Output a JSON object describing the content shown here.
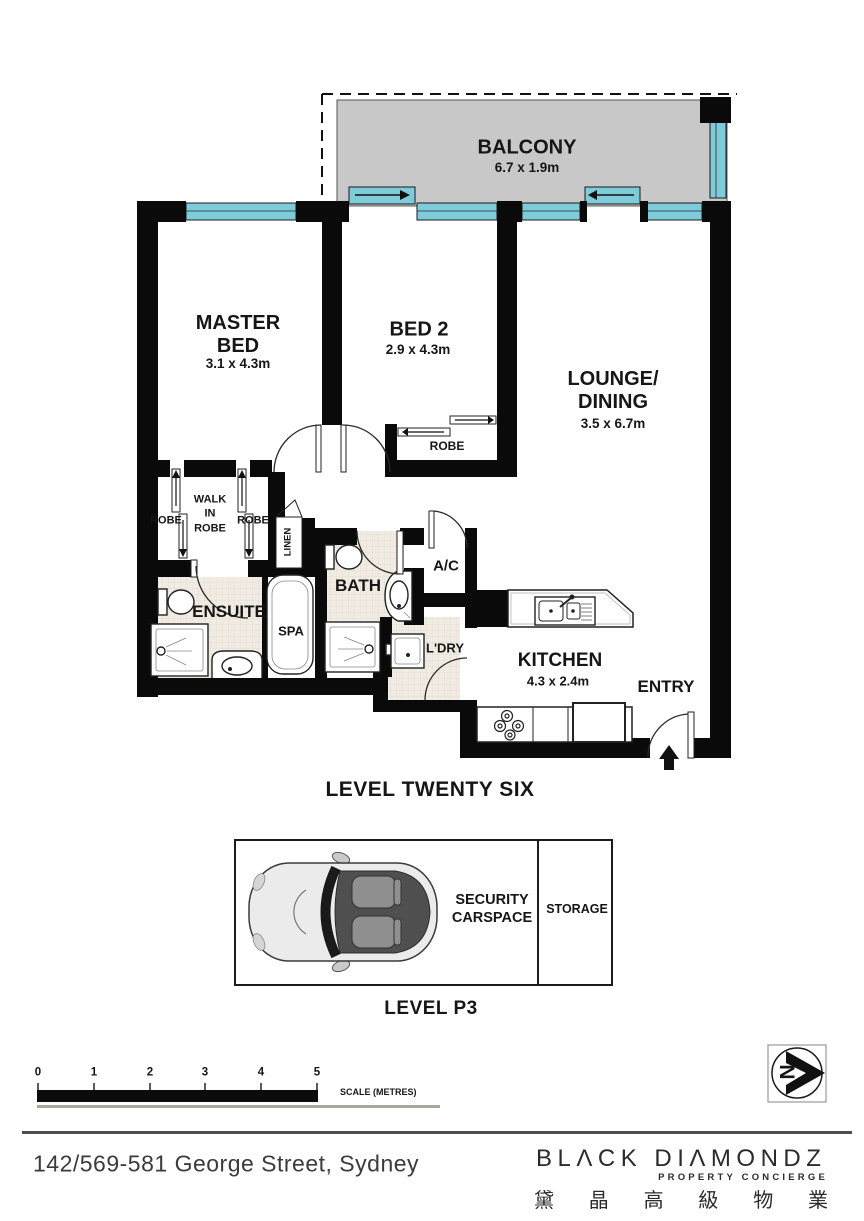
{
  "plan": {
    "level_label": "LEVEL TWENTY SIX",
    "rooms": {
      "balcony": {
        "name": "BALCONY",
        "dims": "6.7 x 1.9m"
      },
      "master_bed": {
        "name": "MASTER\nBED",
        "dims": "3.1 x 4.3m"
      },
      "bed2": {
        "name": "BED 2",
        "dims": "2.9 x 4.3m"
      },
      "lounge_dining": {
        "name": "LOUNGE/\nDINING",
        "dims": "3.5 x 6.7m"
      },
      "kitchen": {
        "name": "KITCHEN",
        "dims": "4.3 x 2.4m"
      },
      "entry": {
        "name": "ENTRY"
      },
      "ensuite": {
        "name": "ENSUITE"
      },
      "spa": {
        "name": "SPA"
      },
      "bath": {
        "name": "BATH"
      },
      "ac": {
        "name": "A/C"
      },
      "laundry": {
        "name": "L'DRY"
      },
      "linen": {
        "name": "LINEN"
      },
      "walk_in_robe": {
        "name": "WALK\nIN\nROBE"
      },
      "robe_left": {
        "name": "ROBE"
      },
      "robe_right": {
        "name": "ROBE"
      },
      "robe_bed2": {
        "name": "ROBE"
      }
    }
  },
  "parking": {
    "carspace_label": "SECURITY\nCARSPACE",
    "storage_label": "STORAGE",
    "level_label": "LEVEL P3"
  },
  "scale_bar": {
    "ticks": [
      "0",
      "1",
      "2",
      "3",
      "4",
      "5"
    ],
    "label": "SCALE (METRES)"
  },
  "compass": {
    "north_label": "N"
  },
  "footer": {
    "address": "142/569-581 George Street, Sydney",
    "brand_name": "BLΛCK DIΛMONDZ",
    "brand_tagline": "PROPERTY CONCIERGE",
    "brand_chinese": [
      "黛",
      "晶",
      "高",
      "級",
      "物",
      "業"
    ]
  },
  "colors": {
    "wall": "#0a0a0a",
    "window": "#7ecbd9",
    "balcony": "#c8c8c8",
    "tile": "#f1ece3"
  }
}
